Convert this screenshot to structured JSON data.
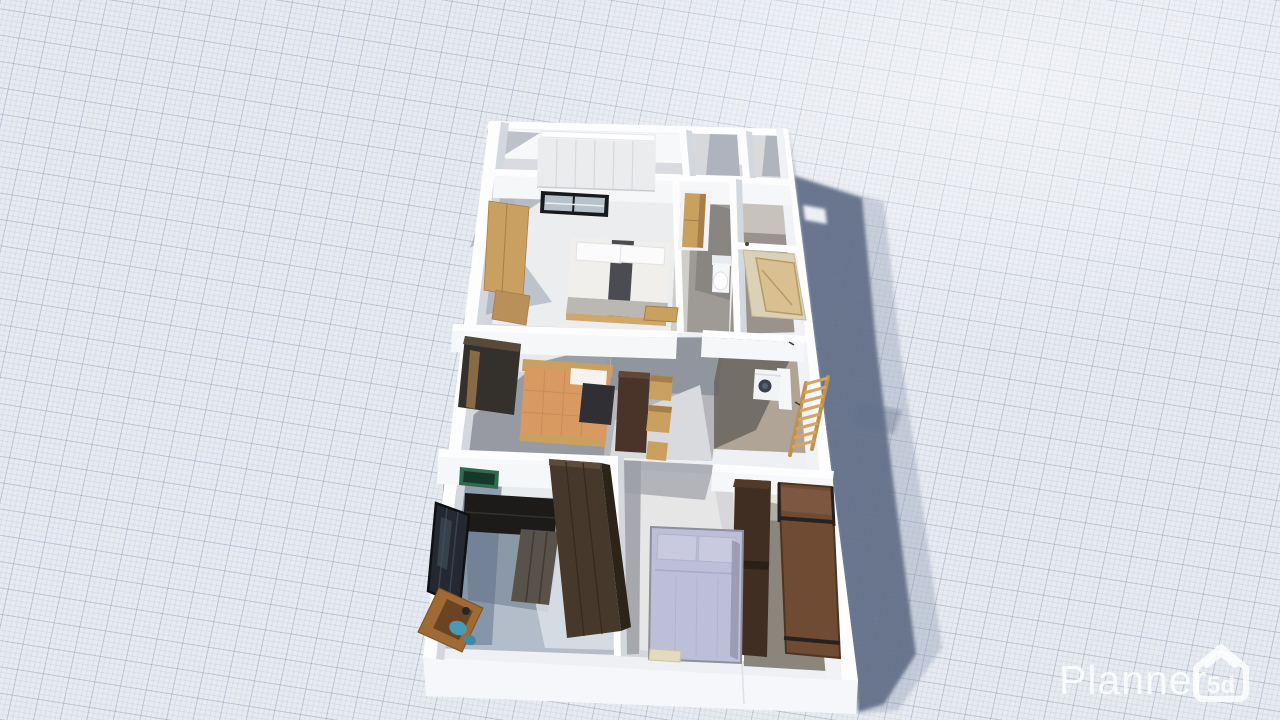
{
  "app": {
    "name": "Planner 5D",
    "view": "3d-render-viewport"
  },
  "watermark": {
    "brand": "Planner",
    "logo": "5d"
  },
  "theme": {
    "colors": {
      "bg": "#e7eaf0",
      "gridMajor": "rgba(123,140,170,0.30)",
      "gridMinor": "rgba(123,140,170,0.11)",
      "shadowDark": "#5f6d86",
      "shadowLight": "#8e9cb2",
      "plate": "#eef0f3",
      "wall": "#fdfdfe",
      "wallFace": "#f6f7f9",
      "wallShade": "#d3d8df",
      "wood": "#c9a05f",
      "woodDark": "#a87e48",
      "darkFurn": "#46392b",
      "sofaDark": "#1d1b19",
      "sofaSeat": "#59524a",
      "lavender": "#bdbed8",
      "orange": "#d99a62",
      "brown": "#6f4b34",
      "brownDark": "#3f2e21",
      "blue": "#4a9ab5",
      "green": "#2e6b4f",
      "watermark": "rgba(255,255,255,0.8)"
    }
  },
  "scene": {
    "rooms": {
      "walk_in_closet": "Walk-in closet",
      "bedroom_1": "Bedroom 1",
      "bedroom_2": "Bedroom 2",
      "hallway": "Hallway",
      "shower_room": "Shower room",
      "utility_area": "Utility area",
      "kids_room": "Kids room",
      "living_room": "Living room",
      "corridor": "Bottom corridor"
    },
    "furniture": {
      "wardrobe_white": "Built-in white wardrobe",
      "window": "Interior window",
      "wardrobe_wood": "Wooden wardrobe",
      "double_bed_white": "Double bed with white duvet",
      "bench": "Wooden bench",
      "wardrobe_dark": "Dark wardrobe",
      "single_bed_orange": "Single bed with orange blanket",
      "console_desk": "Dark console desk",
      "chair": "Wooden chair",
      "stool": "Wooden stool",
      "cabinet": "Tall wooden cabinet",
      "toilet": "Toilet",
      "shower": "Shower with wooden door",
      "washing_machine": "Washing machine",
      "ladder": "Wooden ladder",
      "bunk_bed_dark": "Dark brown bed",
      "bed_brown": "Brown bed with rails",
      "picture_frame": "Green framed picture",
      "sofa": "Corner sofa",
      "wardrobe_brown": "Large brown wardrobe",
      "glass_door": "Black framed glass door",
      "corner_desk": "Corner desk with blue fans",
      "double_bed_lavender": "Double bed with lavender bedding",
      "bench_beige": "Beige bench"
    }
  }
}
